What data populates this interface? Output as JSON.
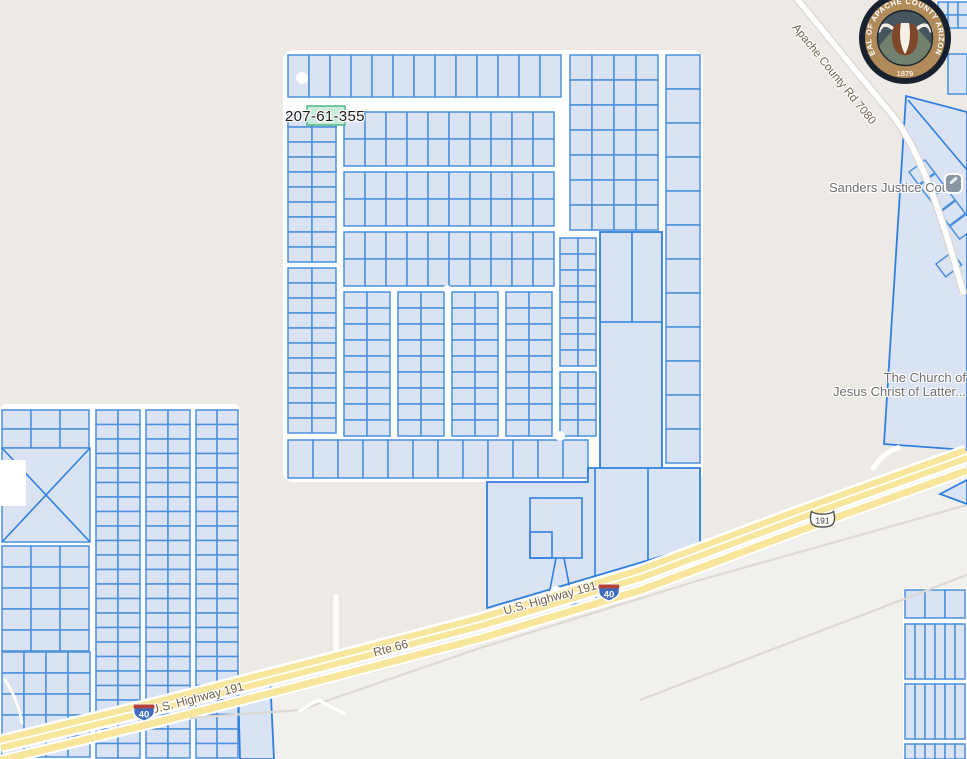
{
  "map": {
    "labels": {
      "parcel_id": "207-61-355",
      "road_7080": "Apache County Rd 7080",
      "justice_court": "Sanders Justice Court",
      "church_line1": "The Church of",
      "church_line2": "Jesus Christ of Latter...",
      "hwy191": "U.S. Highway 191",
      "rte66": "Rte 66"
    },
    "shields": {
      "i40": "40",
      "us191": "191"
    },
    "seal": {
      "ring_text": "SEAL OF APACHE COUNTY ARIZONA",
      "year": "1879"
    },
    "colors": {
      "land": "#edeae5",
      "land_south": "#f1f0ec",
      "street": "#ffffff",
      "parcel_fill": "#d9e3f3",
      "parcel_stroke": "#4a90dd",
      "parcel_stroke_strong": "#2f7fe0",
      "selected_fill": "#c9ecd9",
      "selected_stroke": "#46b582",
      "highway_fill": "#f8e69c",
      "road_casing": "#dbd8d2",
      "faint_road": "#dcd9d3",
      "label_gray": "#6f6f6f",
      "road_label": "#70614a",
      "shield_blue": "#3d6cc0",
      "shield_red": "#b5453a",
      "seal_ring": "#b18b5a",
      "seal_dark": "#18222e",
      "seal_inner": "#46565f",
      "seal_mountain": "#72816e",
      "seal_bull": "#80462a",
      "seal_cream": "#f6f1e8"
    }
  }
}
